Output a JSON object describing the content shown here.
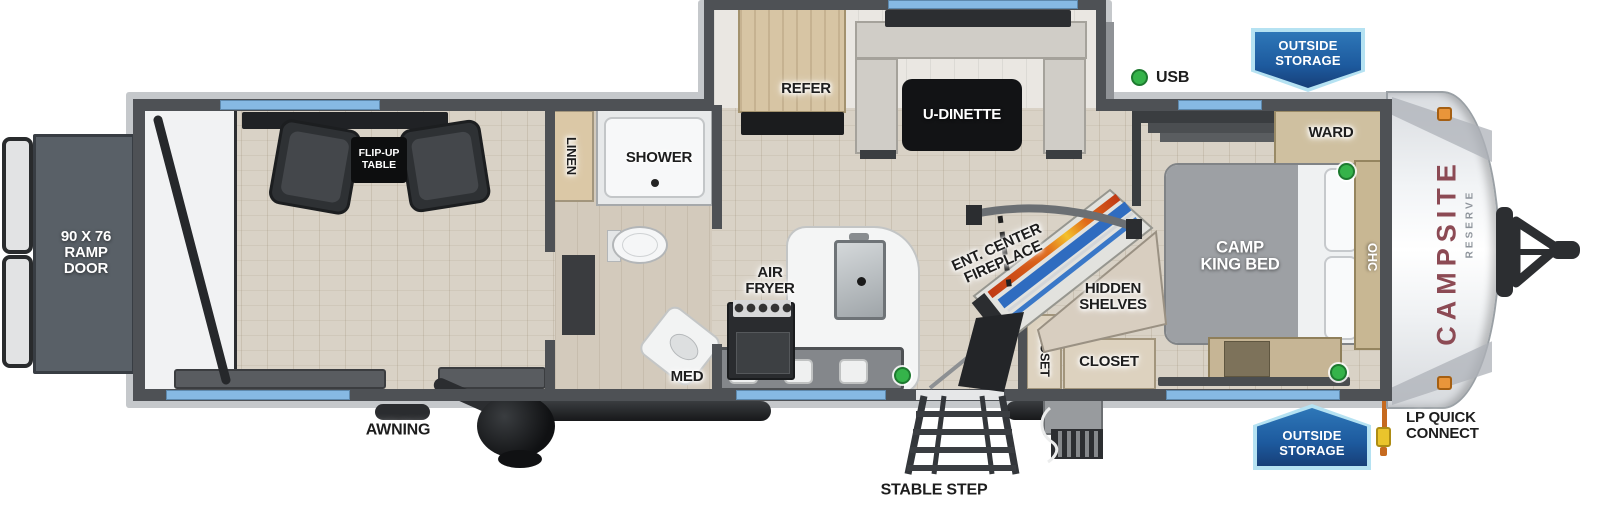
{
  "diagram_type": "travel-trailer-floorplan",
  "brand": {
    "name": "CAMPSITE",
    "series": "RESERVE"
  },
  "labels": {
    "ramp_door": "90 X 76\nRAMP\nDOOR",
    "flip_up_table": "FLIP-UP\nTABLE",
    "linen": "LINEN",
    "shower": "SHOWER",
    "med": "MED",
    "air_fryer": "AIR\nFRYER",
    "refer": "REFER",
    "u_dinette": "U-DINETTE",
    "usb": "USB",
    "outside_storage": "OUTSIDE\nSTORAGE",
    "ward": "WARD",
    "camp_king_bed": "CAMP\nKING BED",
    "ohc": "OHC",
    "ent_center_fireplace": "ENT. CENTER\nFIREPLACE",
    "hidden_shelves": "HIDDEN\nSHELVES",
    "closet": "CLOSET",
    "awning": "AWNING",
    "stable_step": "STABLE STEP",
    "lp_quick_connect": "LP QUICK\nCONNECT"
  },
  "indicators": {
    "usb_ports_marked": 4,
    "marker_color": "#35b34a"
  },
  "colors": {
    "wall_gray": "#4e5155",
    "window_blue": "#86b9e3",
    "banner_blue": "#1d5a9e",
    "banner_border": "#b5e2f2",
    "brand_maroon": "#8c4a54",
    "fireplace_blue": "#2f6cc0",
    "flame_orange": "#e06a1a",
    "lp_hose_orange": "#c66a1f",
    "wood_tan": "#ddd2bf"
  }
}
